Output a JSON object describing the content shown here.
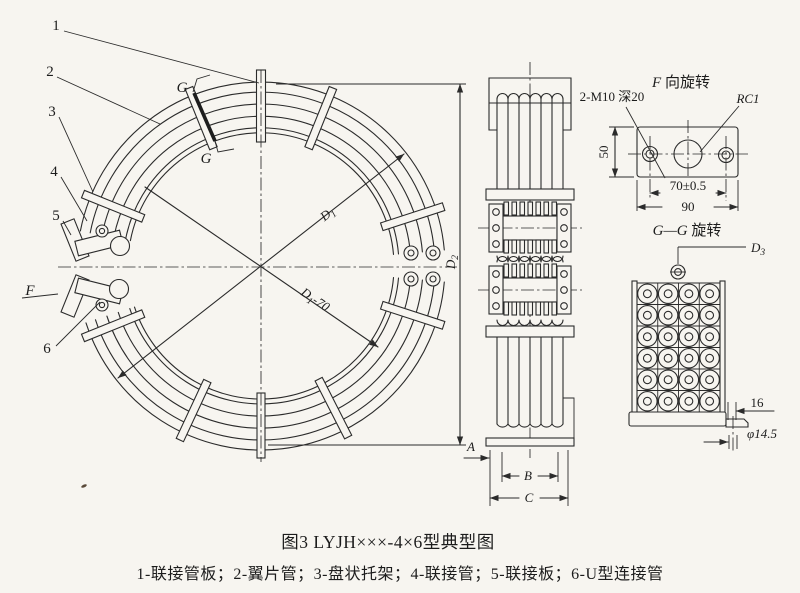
{
  "figure": {
    "caption": "图3 LYJH×××-4×6型典型图",
    "legend": "1-联接管板；2-翼片管；3-盘状托架；4-联接管；5-联接板；6-U型连接管"
  },
  "part_labels": {
    "p1": "1",
    "p2": "2",
    "p3": "3",
    "p4": "4",
    "p5": "5",
    "p6": "6"
  },
  "view_labels": {
    "f_arrow": "F",
    "g_upper": "G",
    "g_lower": "G",
    "f_view_letter": "F",
    "f_view_rest": " 向旋转",
    "gg_view_letters": "G—G",
    "gg_view_rest": " 旋转"
  },
  "dimensions": {
    "d1": {
      "base": "D",
      "sub": "1"
    },
    "d1_minus_70": {
      "base": "D",
      "sub": "1",
      "rest": "-70"
    },
    "d2": {
      "base": "D",
      "sub": "2"
    },
    "d3": {
      "base": "D",
      "sub": "3"
    },
    "thread_note": "2-M10 深20",
    "rc1": "RC1",
    "dim_50": "50",
    "dim_70": "70±0.5",
    "dim_90": "90",
    "dim_16": "16",
    "dim_phi": "φ14.5",
    "dim_a": "A",
    "dim_b": "B",
    "dim_c": "C"
  },
  "drawing": {
    "paper_color": "#f7f5f0",
    "line_color": "#2b2b2b"
  },
  "tube_grid": {
    "columns": 4,
    "rows": 6
  }
}
